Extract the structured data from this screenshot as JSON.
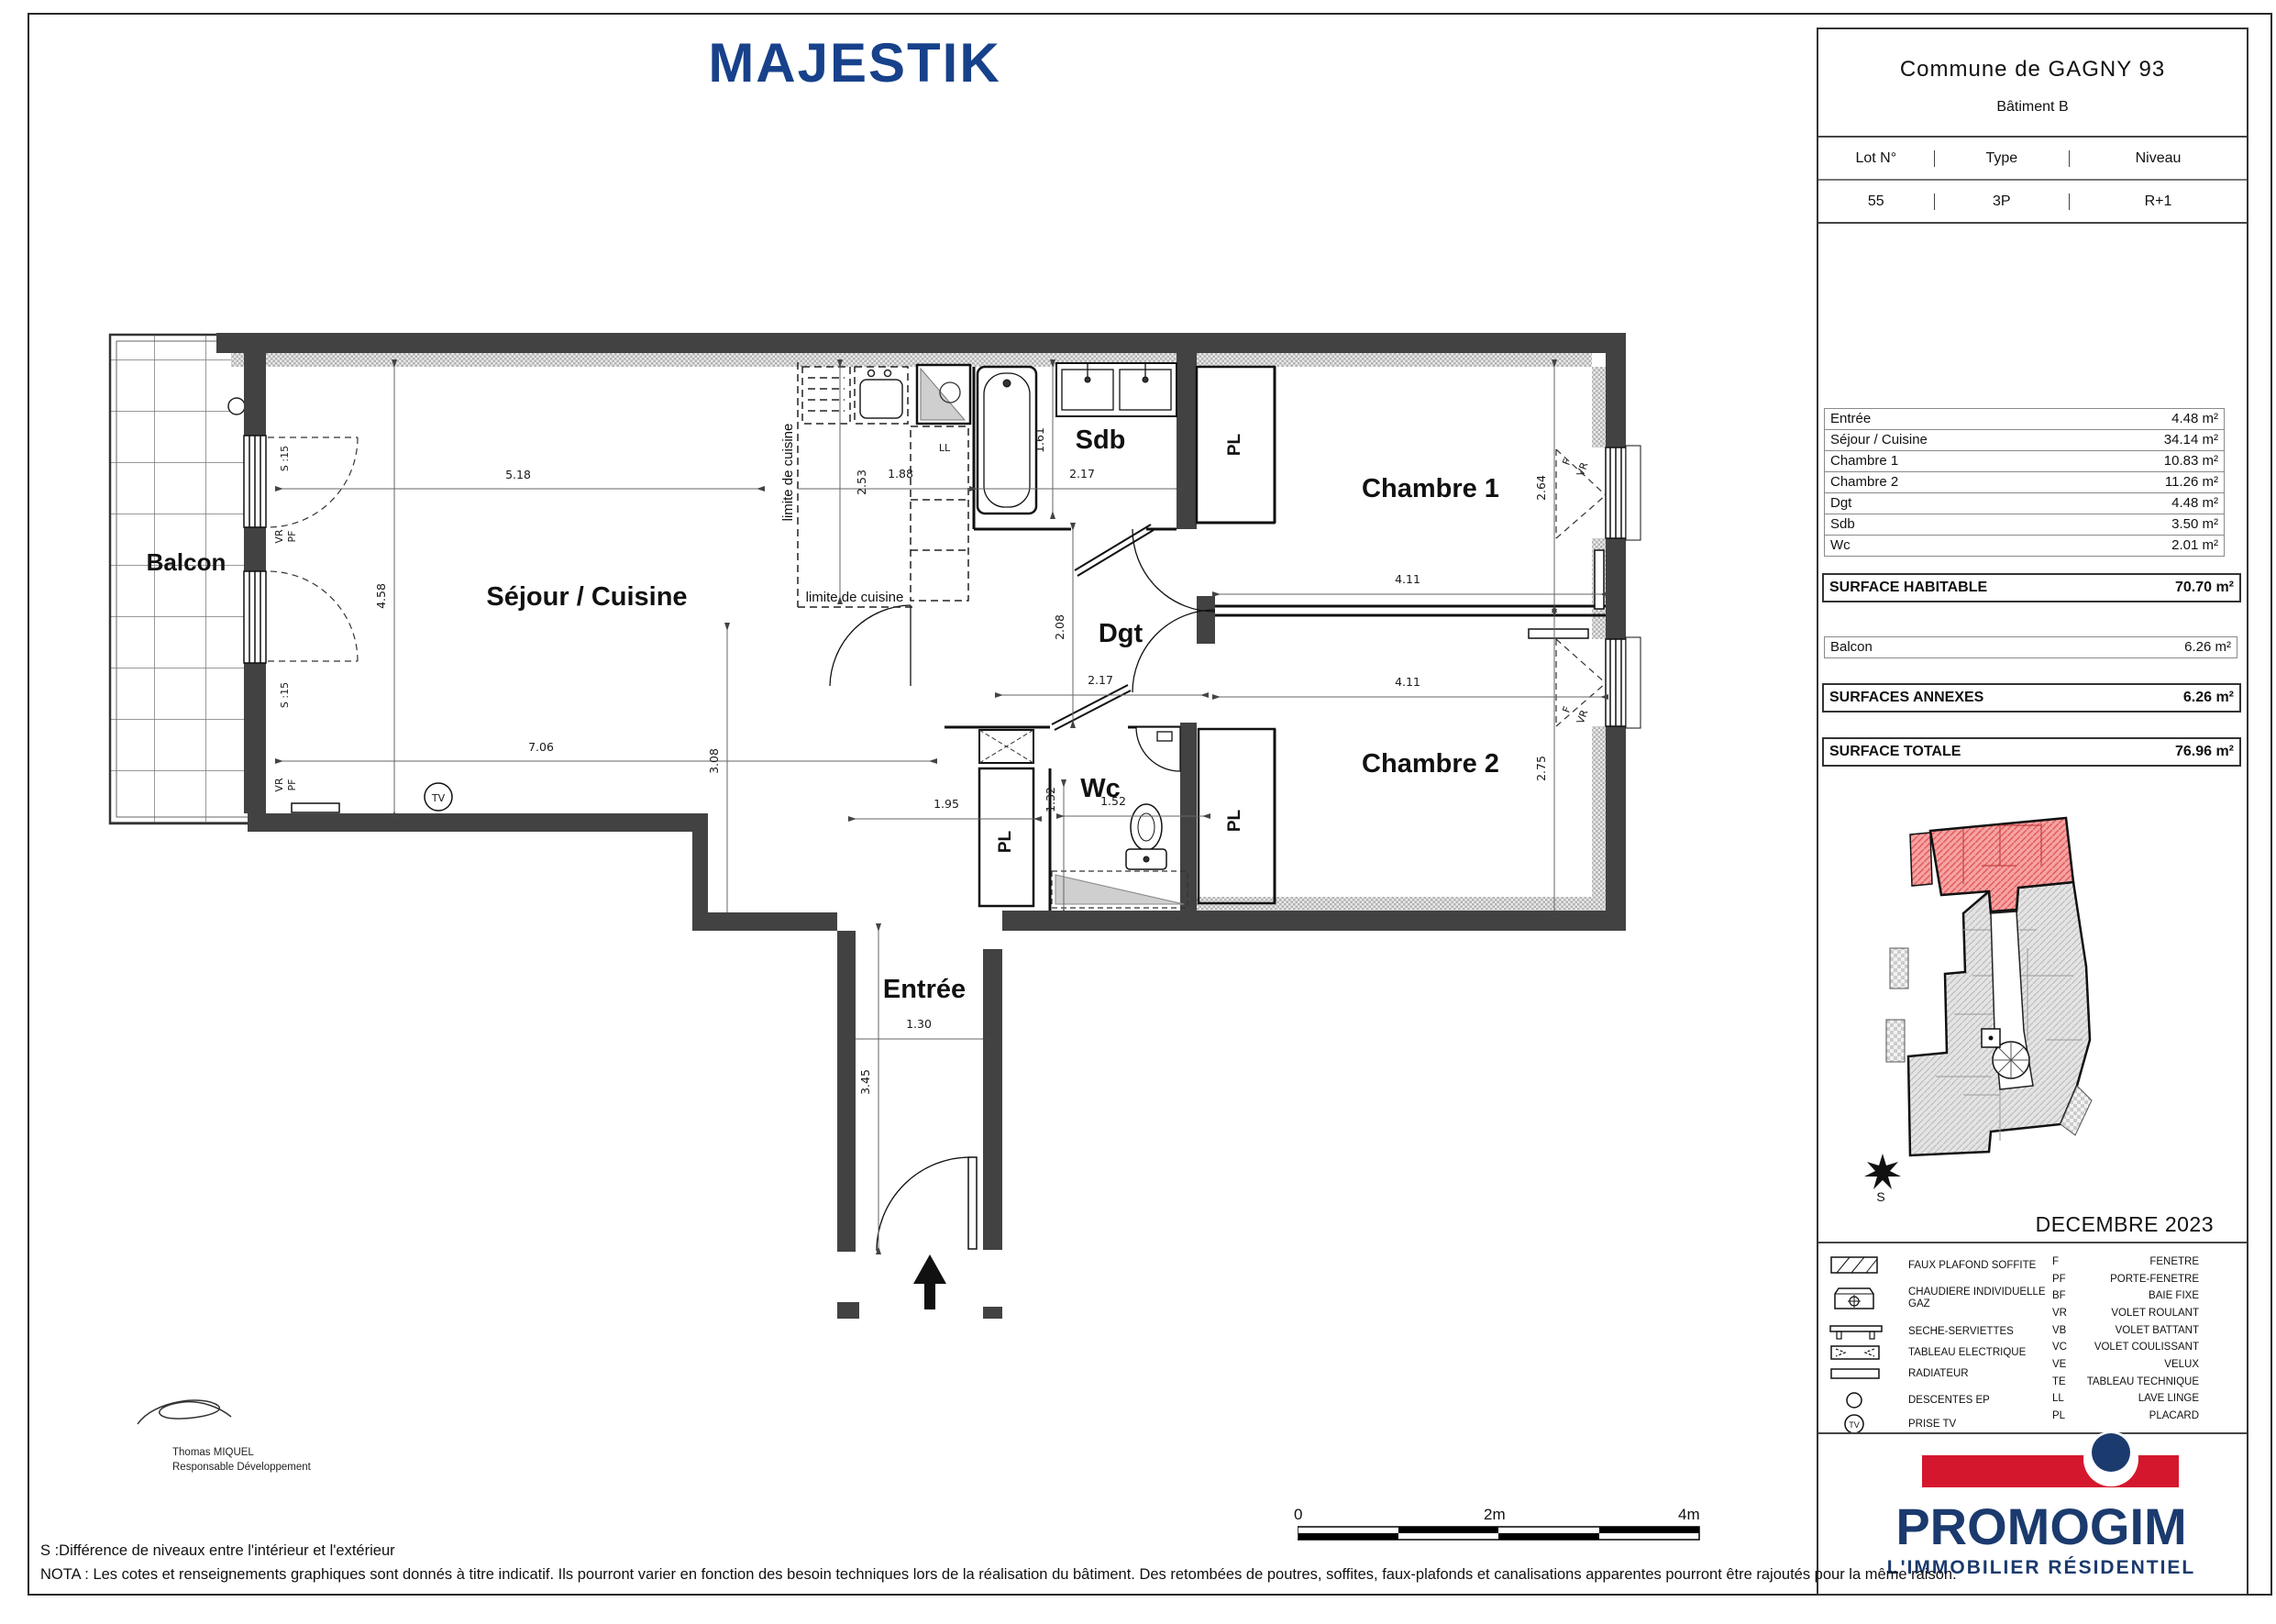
{
  "title": "MAJESTIK",
  "panel": {
    "commune": "Commune de GAGNY   93",
    "batiment": "Bâtiment B",
    "lot": {
      "headers": [
        "Lot N°",
        "Type",
        "Niveau"
      ],
      "values": [
        "55",
        "3P",
        "R+1"
      ]
    },
    "surfaces": [
      {
        "label": "Entrée",
        "value": "4.48 m²"
      },
      {
        "label": "Séjour / Cuisine",
        "value": "34.14 m²"
      },
      {
        "label": "Chambre 1",
        "value": "10.83 m²"
      },
      {
        "label": "Chambre 2",
        "value": "11.26 m²"
      },
      {
        "label": "Dgt",
        "value": "4.48 m²"
      },
      {
        "label": "Sdb",
        "value": "3.50 m²"
      },
      {
        "label": "Wc",
        "value": "2.01 m²"
      }
    ],
    "habitable": {
      "label": "SURFACE HABITABLE",
      "value": "70.70 m²"
    },
    "balcon": {
      "label": "Balcon",
      "value": "6.26 m²"
    },
    "annexes": {
      "label": "SURFACES ANNEXES",
      "value": "6.26 m²"
    },
    "totale": {
      "label": "SURFACE TOTALE",
      "value": "76.96 m²"
    },
    "date": "DECEMBRE 2023",
    "compass": "S",
    "legend": [
      {
        "icon": "faux-plafond-icon",
        "label": "FAUX PLAFOND SOFFITE"
      },
      {
        "icon": "chaudiere-icon",
        "label": "CHAUDIERE INDIVIDUELLE GAZ"
      },
      {
        "icon": "seche-serviettes-icon",
        "label": "SECHE-SERVIETTES"
      },
      {
        "icon": "tableau-electrique-icon",
        "label": "TABLEAU ELECTRIQUE"
      },
      {
        "icon": "radiateur-icon",
        "label": "RADIATEUR"
      },
      {
        "icon": "descentes-ep-icon",
        "label": "DESCENTES EP"
      },
      {
        "icon": "prise-tv-icon",
        "label": "PRISE TV"
      }
    ],
    "abbr": [
      {
        "k": "F",
        "v": "FENETRE"
      },
      {
        "k": "PF",
        "v": "PORTE-FENETRE"
      },
      {
        "k": "BF",
        "v": "BAIE FIXE"
      },
      {
        "k": "VR",
        "v": "VOLET ROULANT"
      },
      {
        "k": "VB",
        "v": "VOLET BATTANT"
      },
      {
        "k": "VC",
        "v": "VOLET COULISSANT"
      },
      {
        "k": "VE",
        "v": "VELUX"
      },
      {
        "k": "TE",
        "v": "TABLEAU TECHNIQUE"
      },
      {
        "k": "LL",
        "v": "LAVE LINGE"
      },
      {
        "k": "PL",
        "v": "PLACARD"
      }
    ]
  },
  "logo": {
    "name": "PROMOGIM",
    "tagline": "L'IMMOBILIER  RÉSIDENTIEL"
  },
  "plan": {
    "rooms": {
      "balcon": "Balcon",
      "sejour": "Séjour / Cuisine",
      "sdb": "Sdb",
      "chambre1": "Chambre 1",
      "chambre2": "Chambre 2",
      "dgt": "Dgt",
      "wc": "Wc",
      "entree": "Entrée"
    },
    "tags": {
      "pl": "PL",
      "ll": "LL",
      "tv": "TV",
      "limite": "limite de cuisine",
      "s15": "S :15",
      "vr": "VR",
      "pf": "PF",
      "f": "F"
    },
    "dims": {
      "d518": "5.18",
      "d458": "4.58",
      "d706": "7.06",
      "d308": "3.08",
      "d253": "2.53",
      "d188": "1.88",
      "d161": "1.61",
      "d217a": "2.17",
      "d208": "2.08",
      "d217b": "2.17",
      "d411a": "4.11",
      "d264": "2.64",
      "d411b": "4.11",
      "d275": "2.75",
      "d195": "1.95",
      "d132": "1.32",
      "d152": "1.52",
      "d130": "1.30",
      "d345": "3.45"
    }
  },
  "footer": {
    "s_note": "S :Différence de niveaux entre l'intérieur et l'extérieur",
    "nota": "NOTA : Les cotes et renseignements graphiques sont donnés à titre indicatif. Ils pourront varier en fonction des besoin techniques lors de la réalisation du bâtiment. Des retombées de poutres, soffites, faux-plafonds et canalisations apparentes pourront être rajoutés pour la même raison.",
    "scale": {
      "s0": "0",
      "s2": "2m",
      "s4": "4m"
    },
    "signature": {
      "name": "Thomas MIQUEL",
      "role": "Responsable Développement"
    }
  }
}
